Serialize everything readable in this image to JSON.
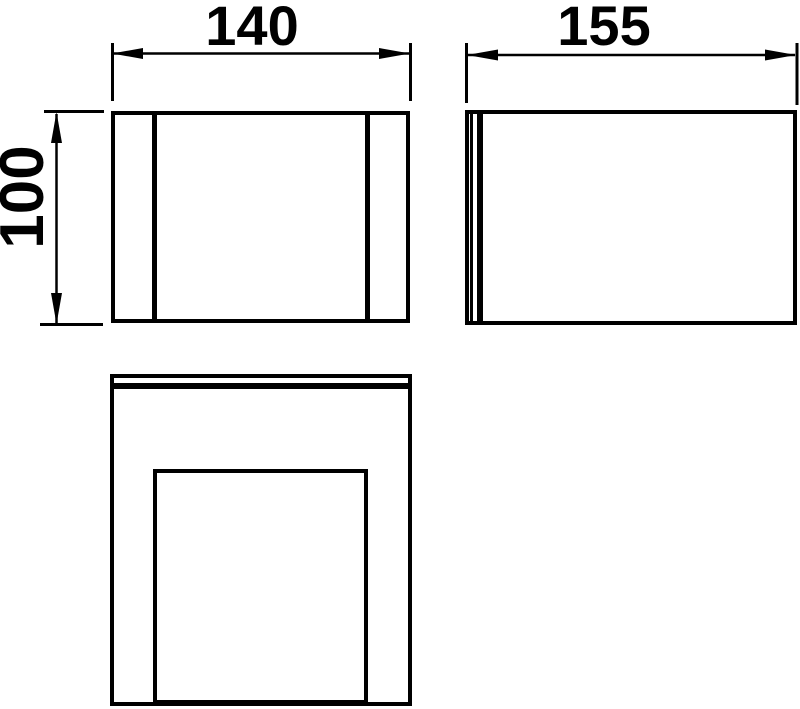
{
  "colors": {
    "background": "#ffffff",
    "line": "#000000"
  },
  "dimensions": {
    "front_width": "140",
    "side_depth": "155",
    "front_height": "100"
  }
}
